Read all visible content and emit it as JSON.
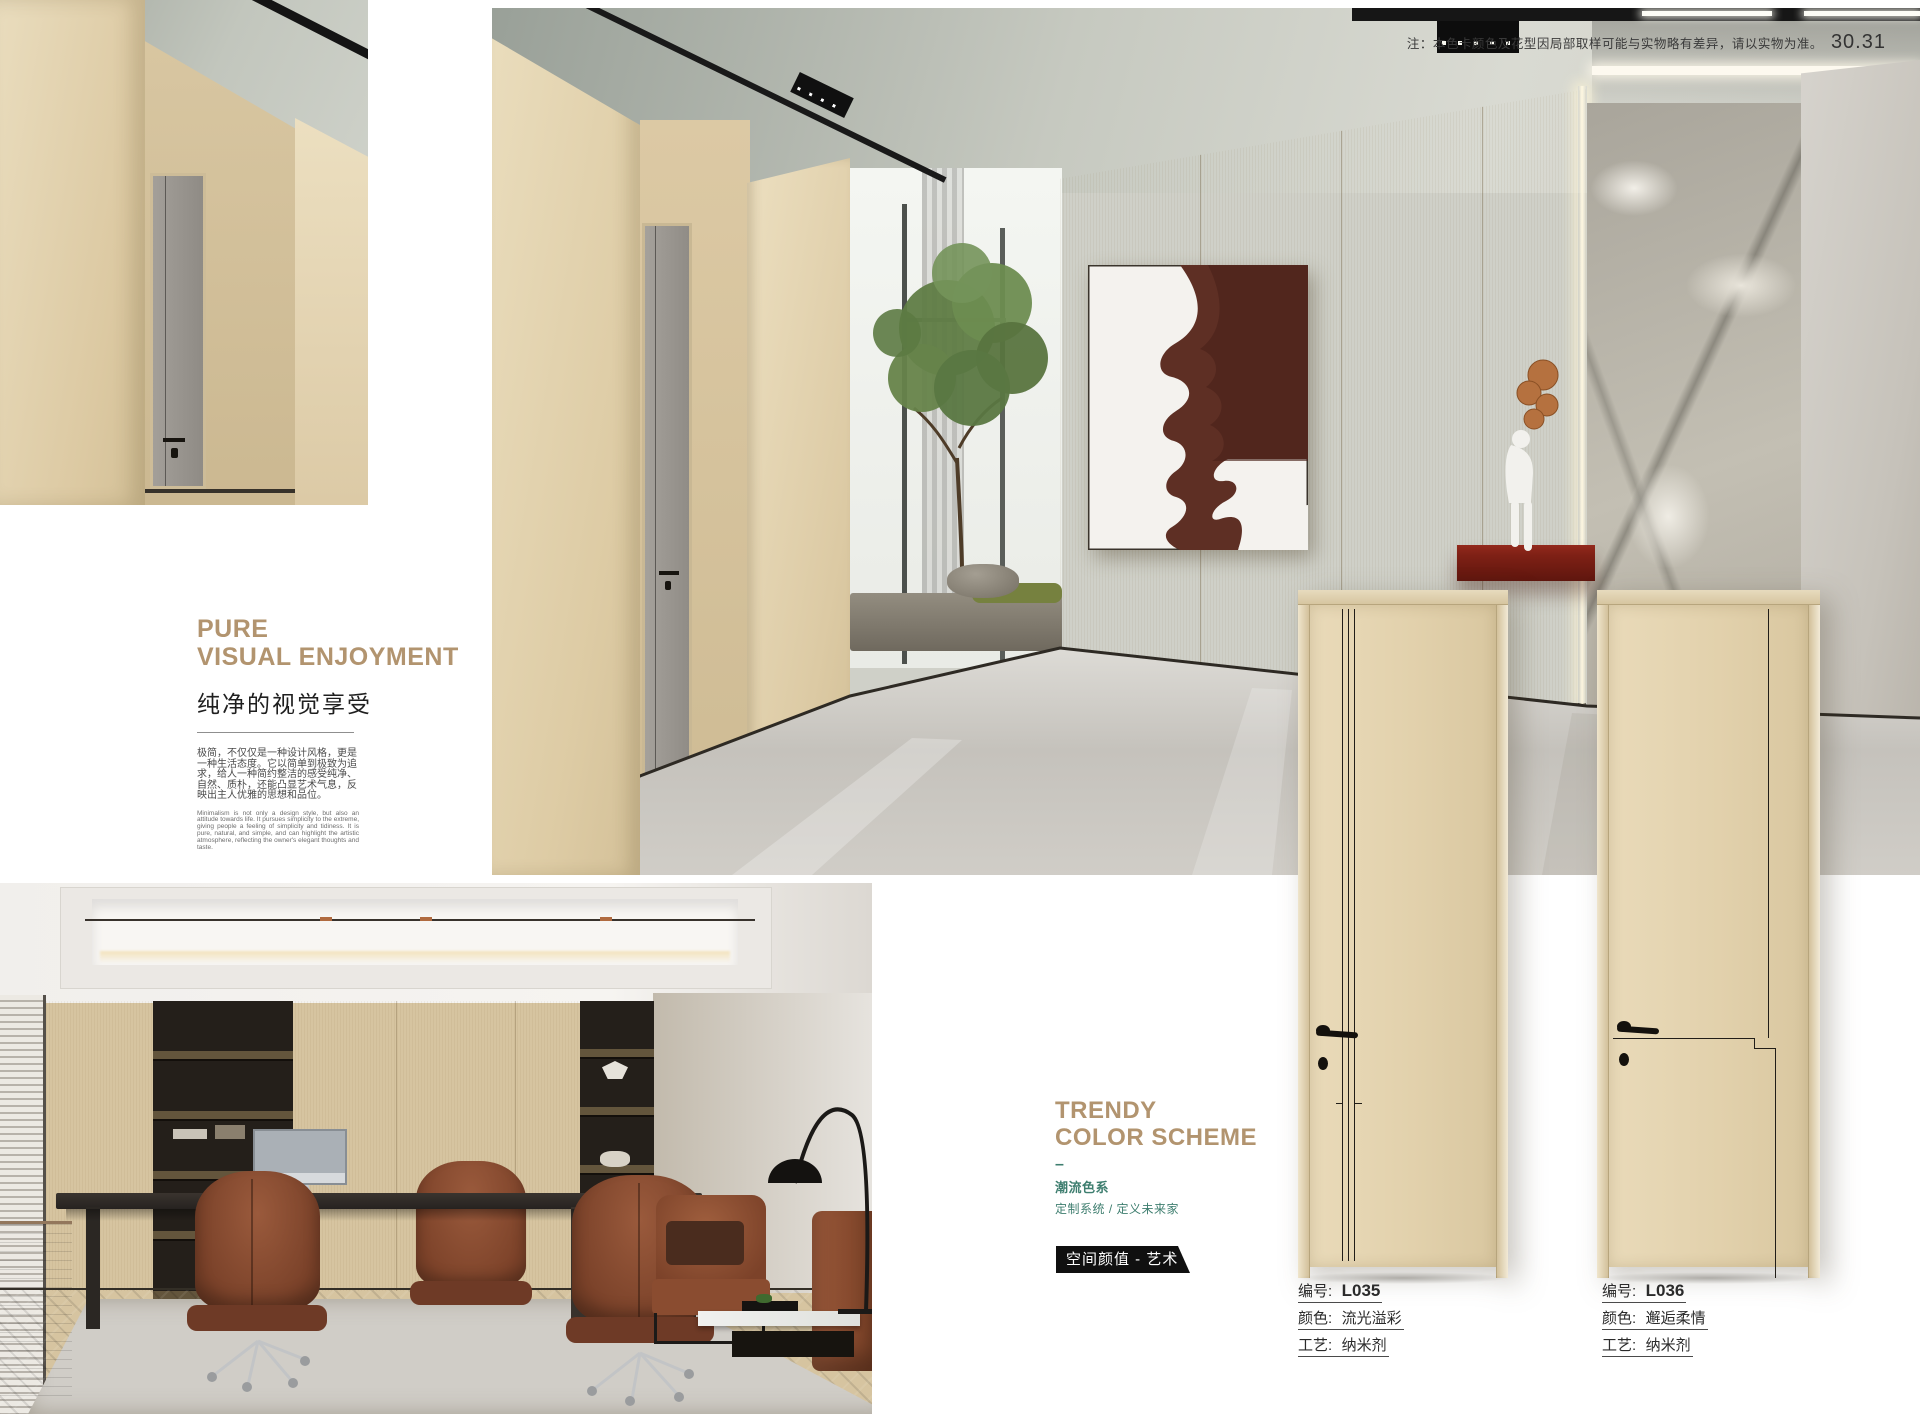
{
  "page": {
    "note": "注：本色卡颜色及花型因局部取样可能与实物略有差异，请以实物为准。",
    "page_number": "30.31"
  },
  "pure_section": {
    "title_line1": "PURE",
    "title_line2": "VISUAL ENJOYMENT",
    "subtitle_zh": "纯净的视觉享受",
    "body_zh": "极简，不仅仅是一种设计风格，更是一种生活态度。它以简单到极致为追求，给人一种简约整洁的感受纯净、自然、质朴，还能凸显艺术气息，反映出主人优雅的思想和品位。",
    "body_en": "Minimalism is not only a design style, but also an attitude towards life. It pursues simplicity to the extreme, giving people a feeling of simplicity and tidiness. It is pure, natural, and simple, and can highlight the artistic atmosphere, reflecting the owner's elegant thoughts and taste."
  },
  "trendy_section": {
    "title_line1": "TRENDY",
    "title_line2": "COLOR SCHEME",
    "dash": "–",
    "subtitle_zh": "潮流色系",
    "tagline_zh": "定制系统 / 定义未来家",
    "badge": "空间颜值 - 艺术"
  },
  "products": [
    {
      "code_label": "编号:",
      "code": "L035",
      "color_label": "颜色:",
      "color": "流光溢彩",
      "craft_label": "工艺:",
      "craft": "纳米剂"
    },
    {
      "code_label": "编号:",
      "code": "L036",
      "color_label": "颜色:",
      "color": "邂逅柔情",
      "craft_label": "工艺:",
      "craft": "纳米剂"
    }
  ],
  "colors": {
    "accent_tan": "#b2946f",
    "accent_teal": "#3e7e6f",
    "badge_bg": "#101010",
    "console_red": "#7e2015"
  }
}
